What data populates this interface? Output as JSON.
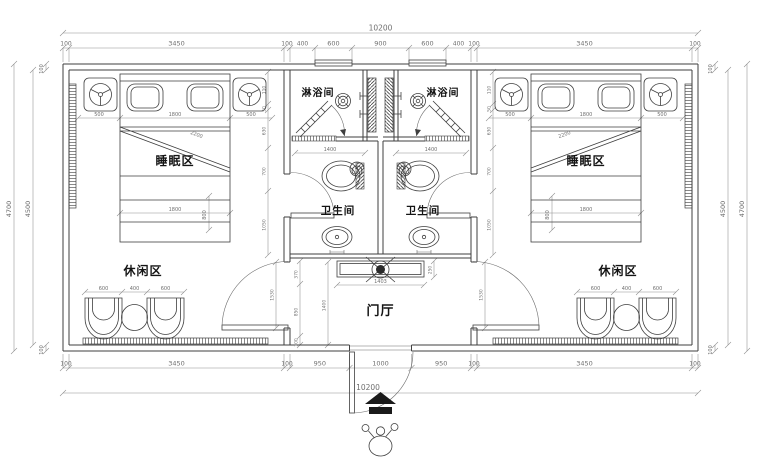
{
  "labels": {
    "sleeping_area": "睡眠区",
    "leisure_area": "休闲区",
    "shower_room": "淋浴间",
    "bathroom": "卫生间",
    "entrance_hall": "门厅"
  },
  "dims": {
    "overall_width": "10200",
    "top_chain": [
      "100",
      "3450",
      "100",
      "400",
      "600",
      "900",
      "600",
      "400",
      "100",
      "3450",
      "100"
    ],
    "bottom_chain": [
      "100",
      "3450",
      "100",
      "950",
      "1000",
      "950",
      "100",
      "3450",
      "100"
    ],
    "side_outer": "4700",
    "side_inner": "4500",
    "wall_thickness": "100",
    "bed_row": [
      "500",
      "1800",
      "500"
    ],
    "bed_length": "1800",
    "bed_width": "800",
    "bed_diagonal": "2200",
    "leisure_row": [
      "600",
      "400",
      "600"
    ],
    "room_chain": [
      "110",
      "50",
      "630",
      "700",
      "1050"
    ],
    "door_opening": "1530",
    "wc_width": "1400",
    "hall_left_chain": [
      "370",
      "850",
      "100"
    ],
    "hall_depth": "1400",
    "cabinet_width": "1403",
    "cabinet_depth": "250"
  }
}
